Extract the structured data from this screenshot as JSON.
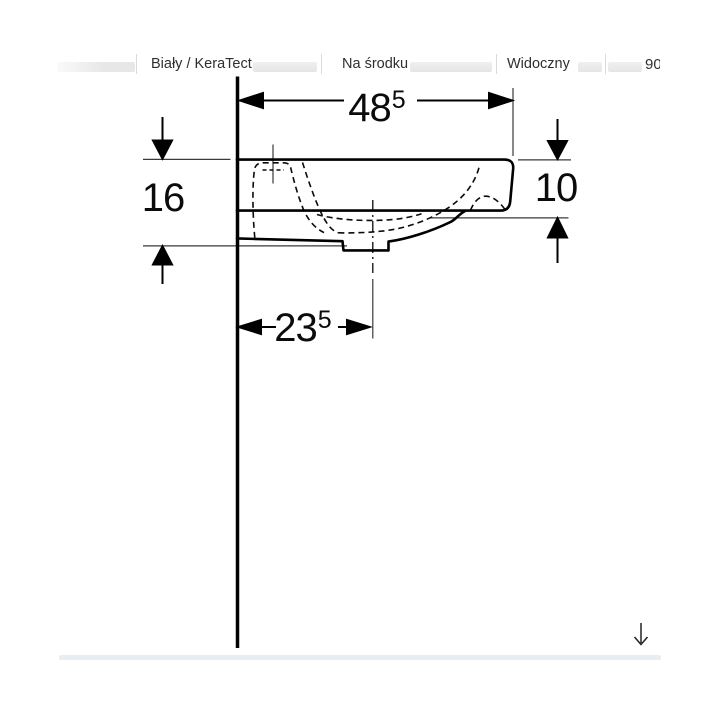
{
  "header": {
    "columns": [
      {
        "label": "Biały / KeraTect"
      },
      {
        "label": "Na środku"
      },
      {
        "label": "Widoczny"
      },
      {
        "label": "90"
      }
    ]
  },
  "drawing": {
    "dims": {
      "top": {
        "whole": "48",
        "sup": "5"
      },
      "left": {
        "whole": "16"
      },
      "right": {
        "whole": "10"
      },
      "bottom": {
        "whole": "23",
        "sup": "5"
      }
    }
  },
  "icons": {
    "scroll_down": "down-arrow-icon"
  },
  "colors": {
    "line": "#000000",
    "thin_line": "#3a3a3a",
    "header_text": "#2f2f2f",
    "separator": "#d9d9d9",
    "pill": "#e9e9e9",
    "scrollbar": "#e8edf4"
  }
}
